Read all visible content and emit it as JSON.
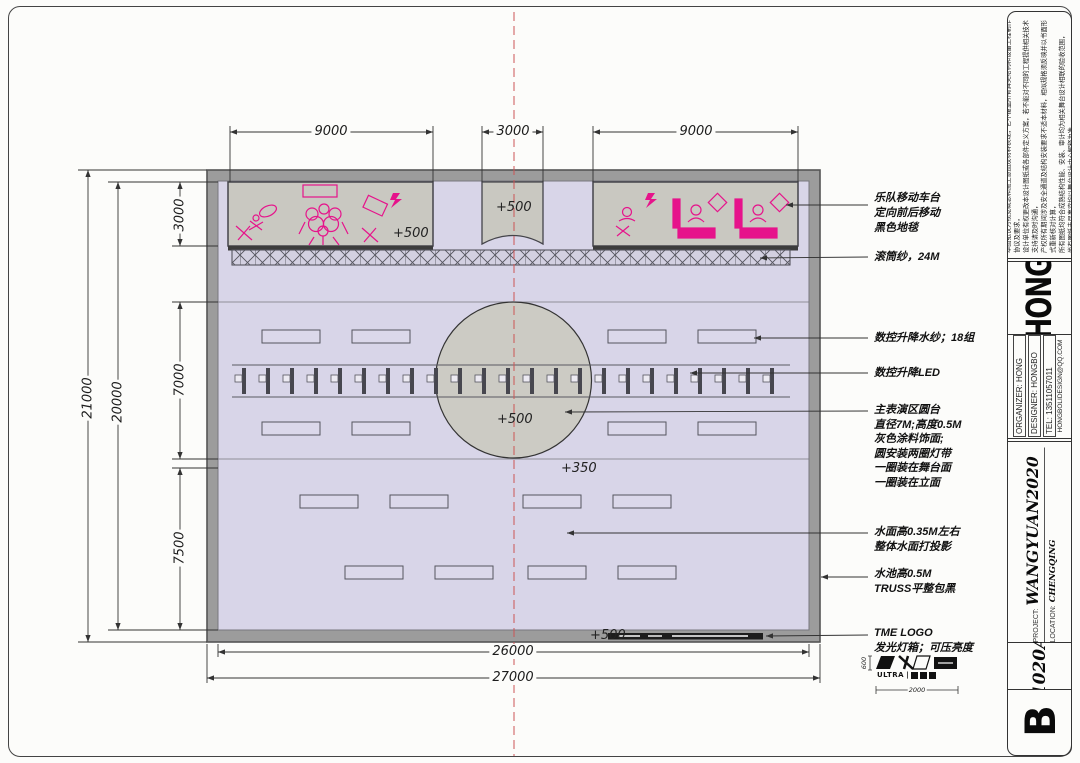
{
  "title_block": {
    "disclaimer_lines": [
      "本图纸仅为视觉概念和施工意图及材料表现，它不覆盖所有舞美结构和设备工程制作协议及要求，",
      "设计单位有权更改本设计图纸或各部件定义方案，若不能对不同的工程提供相关技术支持请及时沟通，",
      "产权所有期间涉及安全通道及结构安装要求不适本材料，相似规格须反映并以书面形式重新核对计算，",
      "所有图纸均符合成熟结构性能、安装、审计均为相关舞台设计相联的验收范围，",
      "尚有图纸未尽事宜均以舞台设计中心解释为准。"
    ],
    "logo": "HONG",
    "info": {
      "organizer": "ORGANIZER: HONG",
      "designer": "DESIGNER: HONGBO",
      "tel": "TEL:  13511057011",
      "email": "HONGBOLIDESIGN@QQ.COM"
    },
    "project_label": "PROJECT:",
    "project_value": "WANGYUAN2020",
    "location_label": "LOCATION:",
    "location_value": "CHENGQING",
    "sheet_code": "1020A",
    "revision": "B"
  },
  "dimensions": {
    "top": [
      "9000",
      "3000",
      "9000"
    ],
    "left_outer": "21000",
    "left_inner": "20000",
    "left_chain": [
      "3000",
      "7000",
      "7500"
    ],
    "bottom_inner": "26000",
    "bottom_outer": "27000"
  },
  "levels": {
    "left_platform": "+500",
    "center_platform": "+500",
    "circle": "+500",
    "water": "+350",
    "bottom_edge": "+500"
  },
  "annotations": [
    {
      "lines": [
        "乐队移动车台",
        "定向前后移动",
        "黑色地毯"
      ]
    },
    {
      "lines": [
        "滚筒纱，24M"
      ]
    },
    {
      "lines": [
        "数控升降水纱；18组"
      ]
    },
    {
      "lines": [
        "数控升降LED"
      ]
    },
    {
      "lines": [
        "主表演区圆台",
        "直径7M;高度0.5M",
        "灰色涂料饰面;",
        "圆安装两圈灯带",
        "一圈装在舞台面",
        "一圈装在立面"
      ]
    },
    {
      "lines": [
        "水面高0.35M左右",
        "整体水面打投影"
      ]
    },
    {
      "lines": [
        "水池高0.5M",
        "TRUSS平整包黑"
      ]
    },
    {
      "lines": [
        "TME LOGO",
        "发光灯箱；可压亮度"
      ]
    }
  ],
  "logo_detail": {
    "text": "ULTRA",
    "dim_height": "600",
    "dim_width": "2000"
  },
  "colors": {
    "accent_pink": "#e6138b",
    "stage_fill": "#d8d5e8",
    "platform_fill": "#c9c8c1",
    "frame_fill": "#9c9c9c",
    "circle_fill": "#cccbc4",
    "centerline_red": "#cc5555"
  }
}
